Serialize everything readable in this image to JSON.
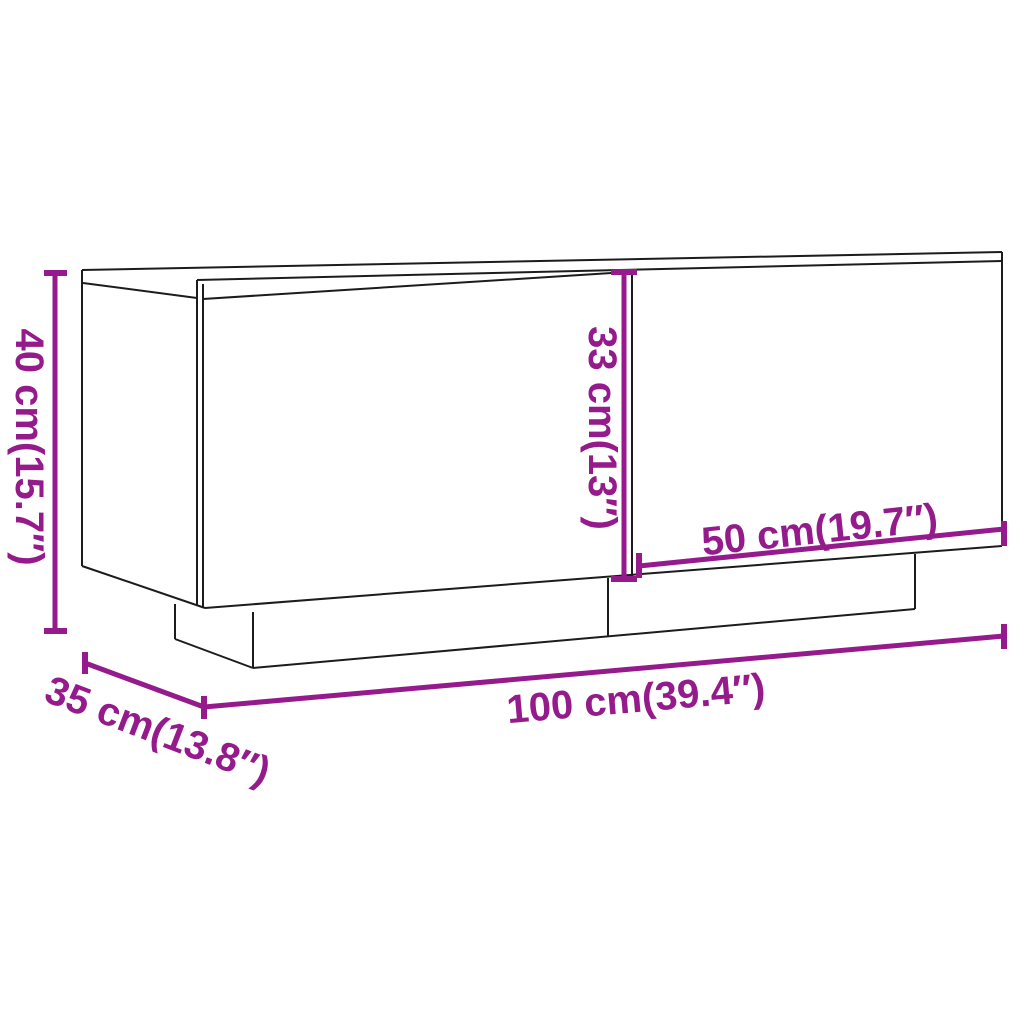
{
  "diagram": {
    "background_color": "#ffffff",
    "outline_color": "#1c1c1c",
    "accent_color": "#951b8c",
    "dimensions": {
      "height": {
        "cm": "40",
        "inch": "15.7",
        "label": "40 cm(15.7″)"
      },
      "door_height": {
        "cm": "33",
        "inch": "13",
        "label": "33 cm(13″)"
      },
      "door_width": {
        "cm": "50",
        "inch": "19.7",
        "label": "50 cm(19.7″)"
      },
      "width": {
        "cm": "100",
        "inch": "39.4",
        "label": "100 cm(39.4″)"
      },
      "depth": {
        "cm": "35",
        "inch": "13.8",
        "label": "35 cm(13.8″)"
      }
    }
  }
}
